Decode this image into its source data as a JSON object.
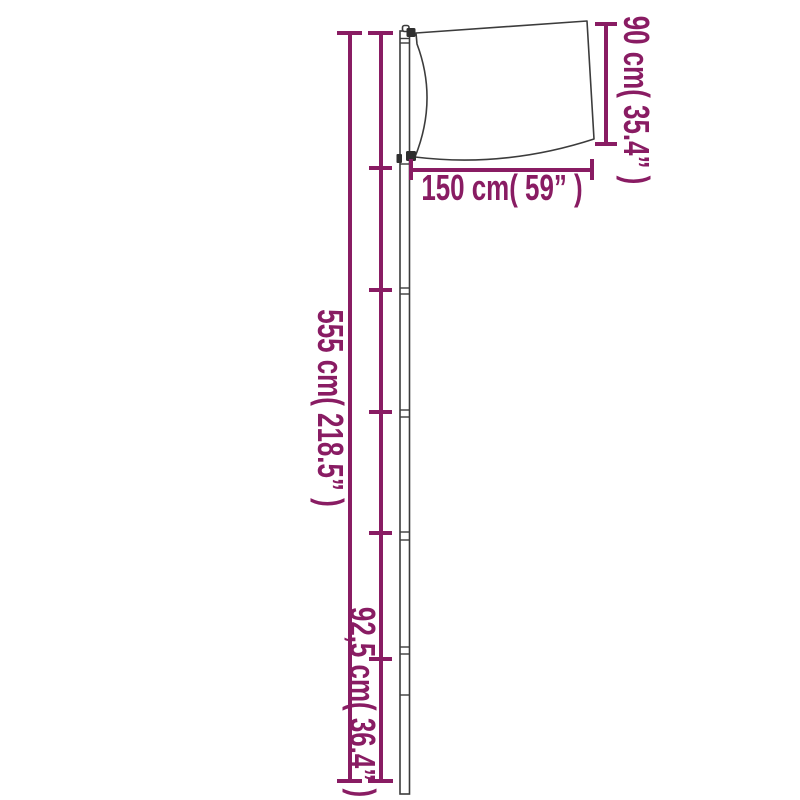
{
  "page": {
    "title": "Flagpole with flag — product dimension diagram",
    "background": "#ffffff"
  },
  "colors": {
    "dimension_accent": "#891c63",
    "drawing_outline": "#3c3c3c",
    "clamp_fill": "#2f2f2f",
    "flag_fill": "#ffffff"
  },
  "diagram": {
    "kind": "product dimension diagram",
    "subject": "telescopic flagpole with flag",
    "pole_sections": 6,
    "labels": {
      "pole_height": "555 cm( 218.5” )",
      "flag_width": "150 cm( 59” )",
      "flag_height": "90 cm( 35.4” )",
      "section_height": "92,5 cm( 36.4” )"
    }
  }
}
